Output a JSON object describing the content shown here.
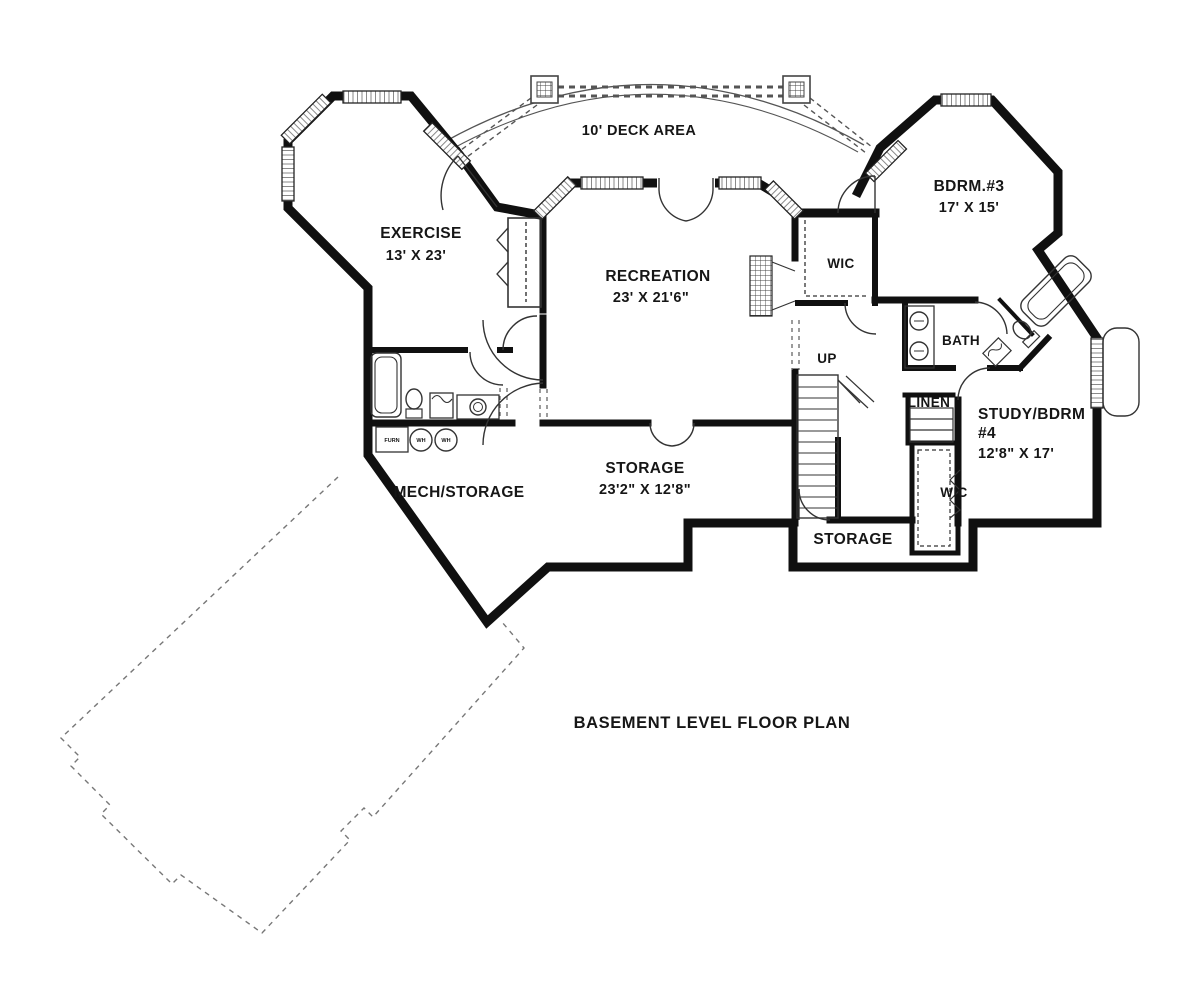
{
  "title": "BASEMENT LEVEL FLOOR PLAN",
  "deck": {
    "label": "10' DECK AREA"
  },
  "rooms": {
    "exercise": {
      "name": "EXERCISE",
      "dims": "13' X 23'"
    },
    "recreation": {
      "name": "RECREATION",
      "dims": "23' X 21'6\""
    },
    "bdrm3": {
      "name": "BDRM.#3",
      "dims": "17' X 15'"
    },
    "wic1": {
      "name": "WIC"
    },
    "bath": {
      "name": "BATH"
    },
    "stairs": {
      "label": "UP"
    },
    "linen": {
      "name": "LINEN"
    },
    "study": {
      "line1": "STUDY/BDRM",
      "line2": "#4",
      "dims": "12'8\" X 17'"
    },
    "wic2": {
      "name": "WIC"
    },
    "storage_center": {
      "name": "STORAGE",
      "dims": "23'2\" X 12'8\""
    },
    "mech": {
      "name": "MECH/STORAGE"
    },
    "storage_right": {
      "name": "STORAGE"
    }
  },
  "fixtures": {
    "furnace": "FURN",
    "water_heater_1": "WH",
    "water_heater_2": "WH"
  },
  "colors": {
    "wall": "#101010",
    "thin_line": "#333333",
    "dashed": "#666666"
  }
}
